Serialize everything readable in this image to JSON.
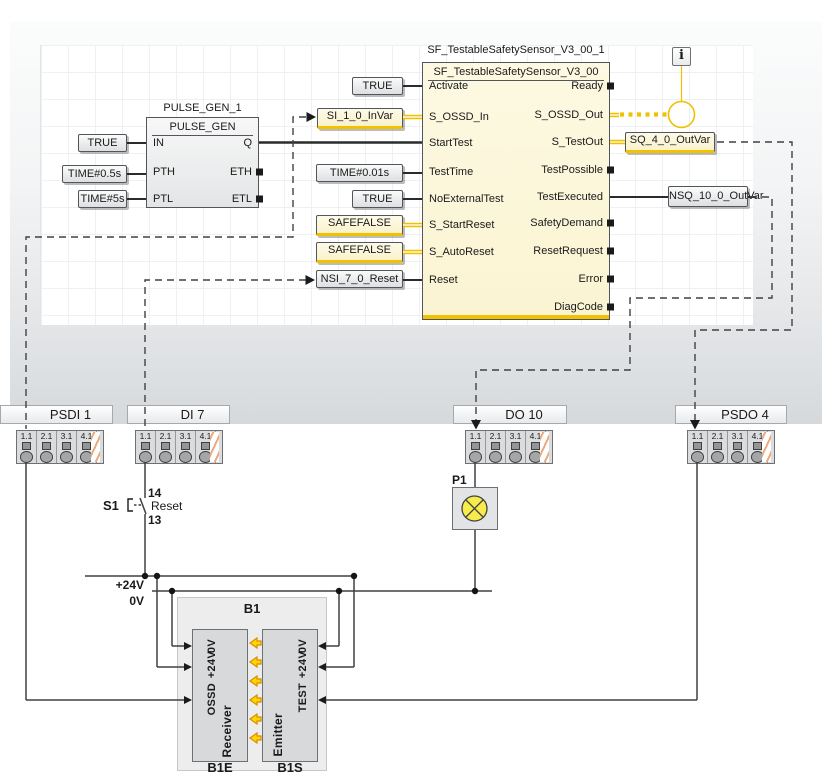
{
  "fbd": {
    "pulse_gen": {
      "instance_label": "PULSE_GEN_1",
      "type_label": "PULSE_GEN",
      "pins_left": [
        "IN",
        "PTH",
        "PTL"
      ],
      "pins_right": [
        "Q",
        "ETH",
        "ETL"
      ],
      "literals": [
        "TRUE",
        "TIME#0.5s",
        "TIME#5s"
      ]
    },
    "safety_block": {
      "instance_label": "SF_TestableSafetySensor_V3_00_1",
      "type_label": "SF_TestableSafetySensor_V3_00",
      "pins_left": [
        "Activate",
        "S_OSSD_In",
        "StartTest",
        "TestTime",
        "NoExternalTest",
        "S_StartReset",
        "S_AutoReset",
        "Reset"
      ],
      "pins_right": [
        "Ready",
        "S_OSSD_Out",
        "S_TestOut",
        "TestPossible",
        "TestExecuted",
        "SafetyDemand",
        "ResetRequest",
        "Error",
        "DiagCode"
      ],
      "in_values": {
        "activate": "TRUE",
        "s_ossd_in": "SI_1_0_InVar",
        "test_time": "TIME#0.01s",
        "no_external_test": "TRUE",
        "s_start_reset": "SAFEFALSE",
        "s_auto_reset": "SAFEFALSE",
        "reset": "NSI_7_0_Reset"
      },
      "out_values": {
        "s_test_out": "SQ_4_0_OutVar",
        "test_executed": "NSQ_10_0_OutVar"
      }
    },
    "info_icon_glyph": "i"
  },
  "hardware": {
    "cell_labels": [
      "1.1",
      "2.1",
      "3.1",
      "4.1"
    ],
    "terminals": [
      {
        "label": "PSDI 1"
      },
      {
        "label": "DI 7"
      },
      {
        "label": "DO 10"
      },
      {
        "label": "PSDO 4"
      }
    ],
    "reset_switch": {
      "label": "S1",
      "contact_top": "14",
      "contact_bottom": "13",
      "function": "Reset"
    },
    "lamp": {
      "label": "P1"
    },
    "power": {
      "p24": "+24V",
      "zero": "0V"
    },
    "sensor": {
      "label": "B1",
      "receiver": {
        "label": "Receiver",
        "tag": "B1E",
        "pins": [
          "0V",
          "+24V",
          "OSSD"
        ]
      },
      "emitter": {
        "label": "Emitter",
        "tag": "B1S",
        "pins": [
          "0V",
          "+24V",
          "TEST"
        ]
      }
    }
  },
  "colors": {
    "safety_yellow": "#efc100",
    "variable_underline": "#f2c100",
    "beam_arrow_fill": "#ffd800",
    "beam_arrow_stroke": "#dc8a00"
  }
}
